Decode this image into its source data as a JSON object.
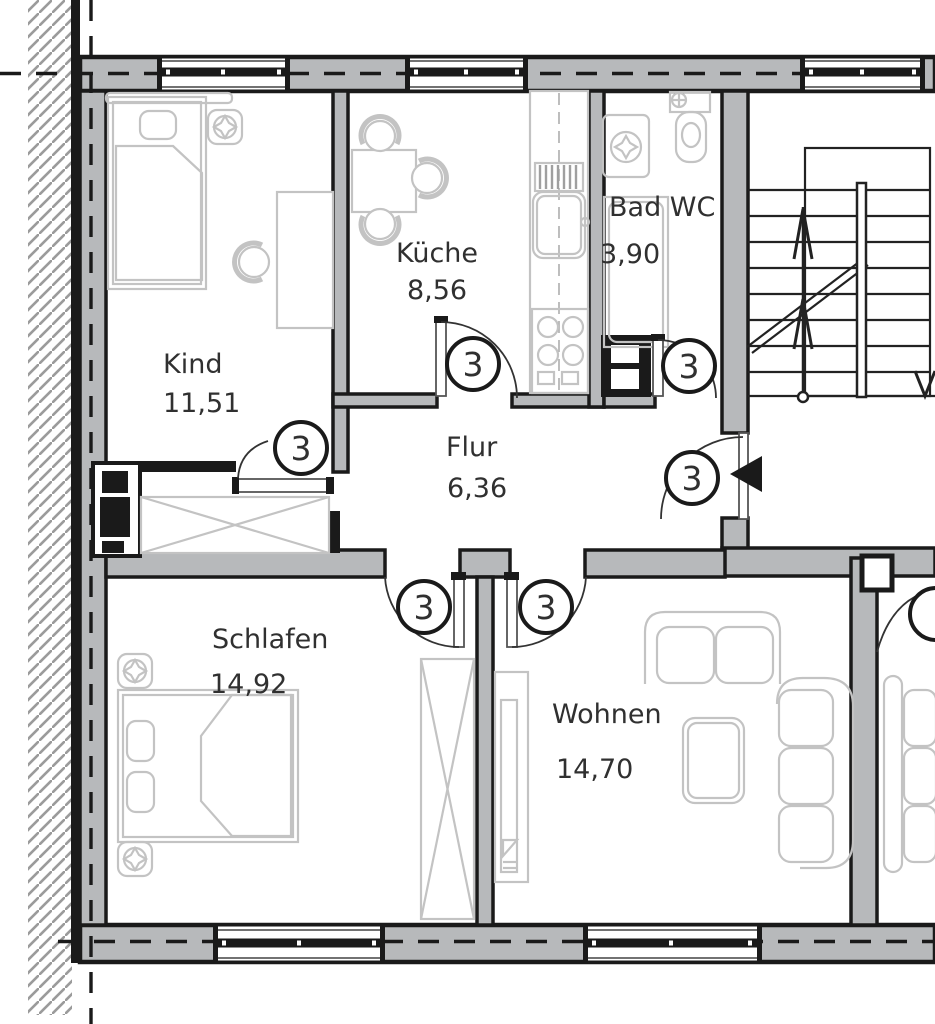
{
  "plan": {
    "rooms": [
      {
        "name": "Kind",
        "area": "11,51"
      },
      {
        "name": "Küche",
        "area": "8,56"
      },
      {
        "name": "Bad WC",
        "area": "3,90"
      },
      {
        "name": "Flur",
        "area": "6,36"
      },
      {
        "name": "Schlafen",
        "area": "14,92"
      },
      {
        "name": "Wohnen",
        "area": "14,70"
      }
    ],
    "door_label": "3",
    "colors": {
      "wall_fill": "#b7b9bb",
      "line": "#1a1a1a",
      "furniture": "#c3c3c3",
      "text": "#303030",
      "background": "#ffffff"
    }
  }
}
